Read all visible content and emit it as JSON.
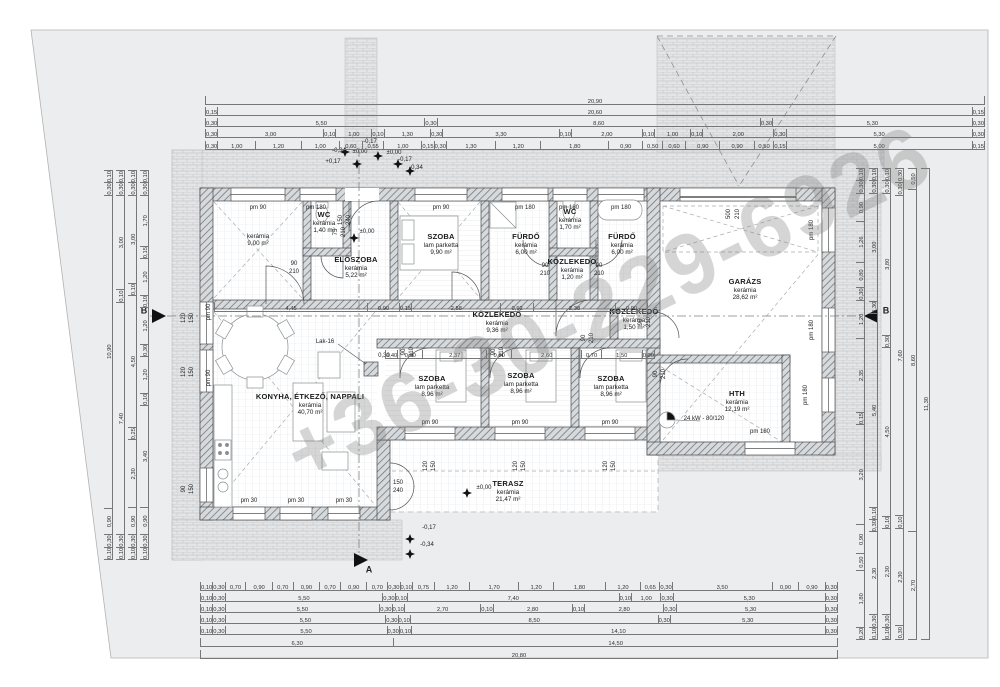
{
  "watermark": "+36-30-229-6926",
  "rooms": [
    {
      "name": "",
      "material": "kerámia",
      "area": "9,00 m²",
      "x": 258,
      "y": 233
    },
    {
      "name": "WC",
      "material": "kerámia",
      "area": "1,40 m²",
      "x": 324,
      "y": 211
    },
    {
      "name": "ELŐSZOBA",
      "material": "kerámia",
      "area": "5,22 m²",
      "x": 356,
      "y": 256
    },
    {
      "name": "SZOBA",
      "material": "lam parketta",
      "area": "9,90 m²",
      "x": 441,
      "y": 233
    },
    {
      "name": "FÜRDŐ",
      "material": "kerámia",
      "area": "6,00 m²",
      "x": 526,
      "y": 233
    },
    {
      "name": "WC",
      "material": "kerámia",
      "area": "1,70 m²",
      "x": 570,
      "y": 208
    },
    {
      "name": "FÜRDŐ",
      "material": "kerámia",
      "area": "6,00 m²",
      "x": 622,
      "y": 233
    },
    {
      "name": "KÖZLEKEDŐ",
      "material": "kerámia",
      "area": "1,20 m²",
      "x": 572,
      "y": 258
    },
    {
      "name": "GARÁZS",
      "material": "kerámia",
      "area": "28,62 m²",
      "x": 745,
      "y": 278
    },
    {
      "name": "KÖZLEKEDŐ",
      "material": "kerámia",
      "area": "9,36 m²",
      "x": 497,
      "y": 311
    },
    {
      "name": "KÖZLEKEDŐ",
      "material": "kerámia",
      "area": "1,50 m²",
      "x": 634,
      "y": 308
    },
    {
      "name": "SZOBA",
      "material": "lam parketta",
      "area": "8,96 m²",
      "x": 432,
      "y": 375
    },
    {
      "name": "SZOBA",
      "material": "lam parketta",
      "area": "8,96 m²",
      "x": 521,
      "y": 372
    },
    {
      "name": "SZOBA",
      "material": "lam parketta",
      "area": "8,96 m²",
      "x": 611,
      "y": 375
    },
    {
      "name": "KONYHA, ÉTKEZŐ, NAPPALI",
      "material": "kerámia",
      "area": "40,70 m²",
      "x": 310,
      "y": 393
    },
    {
      "name": "HTH",
      "material": "kerámia",
      "area": "12,19 m²",
      "x": 737,
      "y": 390
    },
    {
      "name": "TERASZ",
      "material": "kerámia",
      "area": "21,47 m²",
      "x": 508,
      "y": 480
    }
  ],
  "tags": [
    {
      "t": "pm 90",
      "x": 258,
      "y": 208
    },
    {
      "t": "pm 180",
      "x": 316,
      "y": 208
    },
    {
      "t": "pm 90",
      "x": 441,
      "y": 208
    },
    {
      "t": "pm 180",
      "x": 525,
      "y": 208
    },
    {
      "t": "pm 180",
      "x": 569,
      "y": 208
    },
    {
      "t": "pm 180",
      "x": 621,
      "y": 208
    },
    {
      "t": "pm 90",
      "x": 430,
      "y": 423
    },
    {
      "t": "pm 90",
      "x": 520,
      "y": 423
    },
    {
      "t": "pm 90",
      "x": 610,
      "y": 423
    },
    {
      "t": "pm 30",
      "x": 249,
      "y": 501
    },
    {
      "t": "pm 30",
      "x": 296,
      "y": 501
    },
    {
      "t": "pm 30",
      "x": 344,
      "y": 501
    },
    {
      "t": "pm 180",
      "x": 812,
      "y": 230,
      "r": 1
    },
    {
      "t": "pm 180",
      "x": 812,
      "y": 330,
      "r": 1
    },
    {
      "t": "pm 180",
      "x": 806,
      "y": 395,
      "r": 1
    },
    {
      "t": "pm 180",
      "x": 760,
      "y": 432
    },
    {
      "t": "pm 90",
      "x": 209,
      "y": 312,
      "r": 1
    },
    {
      "t": "pm 90",
      "x": 209,
      "y": 378,
      "r": 1
    },
    {
      "t": "90",
      "x": 294,
      "y": 264
    },
    {
      "t": "210",
      "x": 294,
      "y": 272
    },
    {
      "t": "75",
      "x": 336,
      "y": 232,
      "r": 1
    },
    {
      "t": "210",
      "x": 344,
      "y": 232,
      "r": 1
    },
    {
      "t": "150",
      "x": 341,
      "y": 220,
      "r": 1
    },
    {
      "t": "240",
      "x": 349,
      "y": 220,
      "r": 1
    },
    {
      "t": "90",
      "x": 545,
      "y": 266
    },
    {
      "t": "210",
      "x": 545,
      "y": 274
    },
    {
      "t": "90",
      "x": 599,
      "y": 266
    },
    {
      "t": "210",
      "x": 599,
      "y": 274
    },
    {
      "t": "500",
      "x": 729,
      "y": 214,
      "r": 1
    },
    {
      "t": "210",
      "x": 738,
      "y": 214,
      "r": 1
    },
    {
      "t": "90",
      "x": 404,
      "y": 352,
      "r": 1
    },
    {
      "t": "210",
      "x": 412,
      "y": 352,
      "r": 1
    },
    {
      "t": "90",
      "x": 494,
      "y": 352,
      "r": 1
    },
    {
      "t": "210",
      "x": 502,
      "y": 352,
      "r": 1
    },
    {
      "t": "90",
      "x": 584,
      "y": 338,
      "r": 1
    },
    {
      "t": "210",
      "x": 592,
      "y": 338,
      "r": 1
    },
    {
      "t": "90",
      "x": 641,
      "y": 322,
      "r": 1
    },
    {
      "t": "210",
      "x": 649,
      "y": 322,
      "r": 1
    },
    {
      "t": "90",
      "x": 656,
      "y": 374,
      "r": 1
    },
    {
      "t": "210",
      "x": 664,
      "y": 374,
      "r": 1
    },
    {
      "t": "120",
      "x": 426,
      "y": 466,
      "r": 1
    },
    {
      "t": "150",
      "x": 434,
      "y": 466,
      "r": 1
    },
    {
      "t": "120",
      "x": 516,
      "y": 466,
      "r": 1
    },
    {
      "t": "150",
      "x": 524,
      "y": 466,
      "r": 1
    },
    {
      "t": "120",
      "x": 606,
      "y": 466,
      "r": 1
    },
    {
      "t": "150",
      "x": 614,
      "y": 466,
      "r": 1
    },
    {
      "t": "120",
      "x": 184,
      "y": 318,
      "r": 1
    },
    {
      "t": "150",
      "x": 192,
      "y": 318,
      "r": 1
    },
    {
      "t": "120",
      "x": 184,
      "y": 372,
      "r": 1
    },
    {
      "t": "150",
      "x": 192,
      "y": 372,
      "r": 1
    },
    {
      "t": "90",
      "x": 184,
      "y": 489,
      "r": 1
    },
    {
      "t": "150",
      "x": 192,
      "y": 489,
      "r": 1
    },
    {
      "t": "150",
      "x": 398,
      "y": 483
    },
    {
      "t": "240",
      "x": 398,
      "y": 491
    },
    {
      "t": "±0,00",
      "x": 360,
      "y": 152
    },
    {
      "t": "-0,17",
      "x": 370,
      "y": 142
    },
    {
      "t": "-0,34",
      "x": 339,
      "y": 151
    },
    {
      "t": "+0,17",
      "x": 333,
      "y": 162
    },
    {
      "t": "±0,00",
      "x": 394,
      "y": 153
    },
    {
      "t": "-0,17",
      "x": 405,
      "y": 160
    },
    {
      "t": "-0,34",
      "x": 416,
      "y": 168
    },
    {
      "t": "±0,00",
      "x": 367,
      "y": 232
    },
    {
      "t": "±0,00",
      "x": 484,
      "y": 488
    },
    {
      "t": "-0,17",
      "x": 429,
      "y": 528
    },
    {
      "t": "-0,34",
      "x": 427,
      "y": 545
    },
    {
      "t": "Lak-16",
      "x": 325,
      "y": 342
    },
    {
      "t": "0,30",
      "x": 384,
      "y": 356
    },
    {
      "t": "24 kW - 80/120",
      "x": 704,
      "y": 419
    },
    {
      "t": "B",
      "x": 144,
      "y": 311,
      "s": 1
    },
    {
      "t": "B",
      "x": 886,
      "y": 311,
      "s": 1
    },
    {
      "t": "A",
      "x": 369,
      "y": 570,
      "s": 1
    }
  ],
  "dims": {
    "top": [
      [
        "20,90"
      ],
      [
        "0,15",
        "20,60",
        "0,15"
      ],
      [
        "0,30",
        "5,50",
        "0,30",
        "8,60",
        "0,30",
        "5,30",
        "0,30"
      ],
      [
        "0,30",
        "3,00",
        "0,10",
        "1,00",
        "0,10",
        "1,30",
        "0,30",
        "3,30",
        "0,10",
        "2,00",
        "0,10",
        "1,00",
        "0,10",
        "2,00",
        "0,30",
        "5,30",
        "0,30"
      ],
      [
        "0,30",
        "1,00",
        "1,20",
        "1,00",
        "0,60",
        "0,55",
        "1,00",
        "0,15",
        "0,30",
        "1,30",
        "1,20",
        "1,80",
        "0,90",
        "0,50",
        "0,60",
        "0,90",
        "0,90",
        "0,50",
        "0,15",
        "5,00",
        "0,15"
      ]
    ],
    "bottom": [
      [
        "0,10",
        "0,30",
        "0,70",
        "0,90",
        "0,70",
        "0,90",
        "0,70",
        "0,90",
        "0,70",
        "0,30",
        "0,10",
        "0,75",
        "1,20",
        "1,70",
        "1,20",
        "1,80",
        "1,20",
        "0,65",
        "0,30",
        "3,50",
        "0,90",
        "0,90",
        "0,30"
      ],
      [
        "0,10",
        "0,30",
        "5,50",
        "0,30",
        "0,10",
        "7,40",
        "0,10",
        "1,00",
        "0,30",
        "5,30",
        "0,30"
      ],
      [
        "0,10",
        "0,30",
        "5,50",
        "0,30",
        "0,10",
        "2,70",
        "0,10",
        "2,80",
        "0,10",
        "2,80",
        "0,30",
        "5,30",
        "0,30"
      ],
      [
        "0,10",
        "0,30",
        "5,50",
        "0,30",
        "0,10",
        "8,50",
        "0,30",
        "5,30",
        "0,30"
      ],
      [
        "0,10",
        "0,30",
        "5,50",
        "0,30",
        "0,10",
        "14,10",
        "0,30"
      ],
      [
        "6,30",
        "14,50"
      ],
      [
        "20,80"
      ]
    ],
    "left": [
      [
        "0,10",
        "0,30",
        "10,90",
        "0,90",
        "0,30",
        "0,10"
      ],
      [
        "0,10",
        "0,30",
        "3,00",
        "0,10",
        "7,40",
        "0,30",
        "0,10"
      ],
      [
        "0,10",
        "0,30",
        "3,00",
        "0,10",
        "4,50",
        "0,25",
        "2,30",
        "0,90",
        "0,30",
        "0,10"
      ],
      [
        "0,10",
        "0,30",
        "1,70",
        "0,15",
        "1,20",
        "0,10",
        "1,20",
        "0,30",
        "1,20",
        "0,10",
        "3,40",
        "0,90",
        "0,30",
        "0,10"
      ]
    ],
    "right": [
      [
        "0,10",
        "0,30",
        "0,90",
        "1,26",
        "0,80",
        "0,30",
        "1,20",
        "2,35",
        "0,15",
        "3,20",
        "0,90",
        "0,50",
        "1,80",
        "0,20"
      ],
      [
        "0,10",
        "0,30",
        "3,00",
        "0,30",
        "5,40",
        "0,10",
        "0,30",
        "2,30",
        "0,30",
        "0,10"
      ],
      [
        "0,10",
        "0,30",
        "3,80",
        "0,30",
        "4,50",
        "0,10",
        "2,30",
        "0,30",
        "0,10"
      ],
      [
        "0,30",
        "0,30",
        "7,60",
        "0,10",
        "2,30",
        "0,30"
      ],
      [
        "0,50",
        "8,60",
        "2,70"
      ],
      [
        "11,30"
      ]
    ],
    "inner": [
      [
        "4,45",
        "0,90",
        "0,15",
        "2,58",
        "0,92",
        "2,38",
        "0,90"
      ],
      [
        "0,40",
        "0,90",
        "2,37",
        "0,90",
        "2,60",
        "0,70",
        "1,50",
        "0,30"
      ]
    ]
  }
}
